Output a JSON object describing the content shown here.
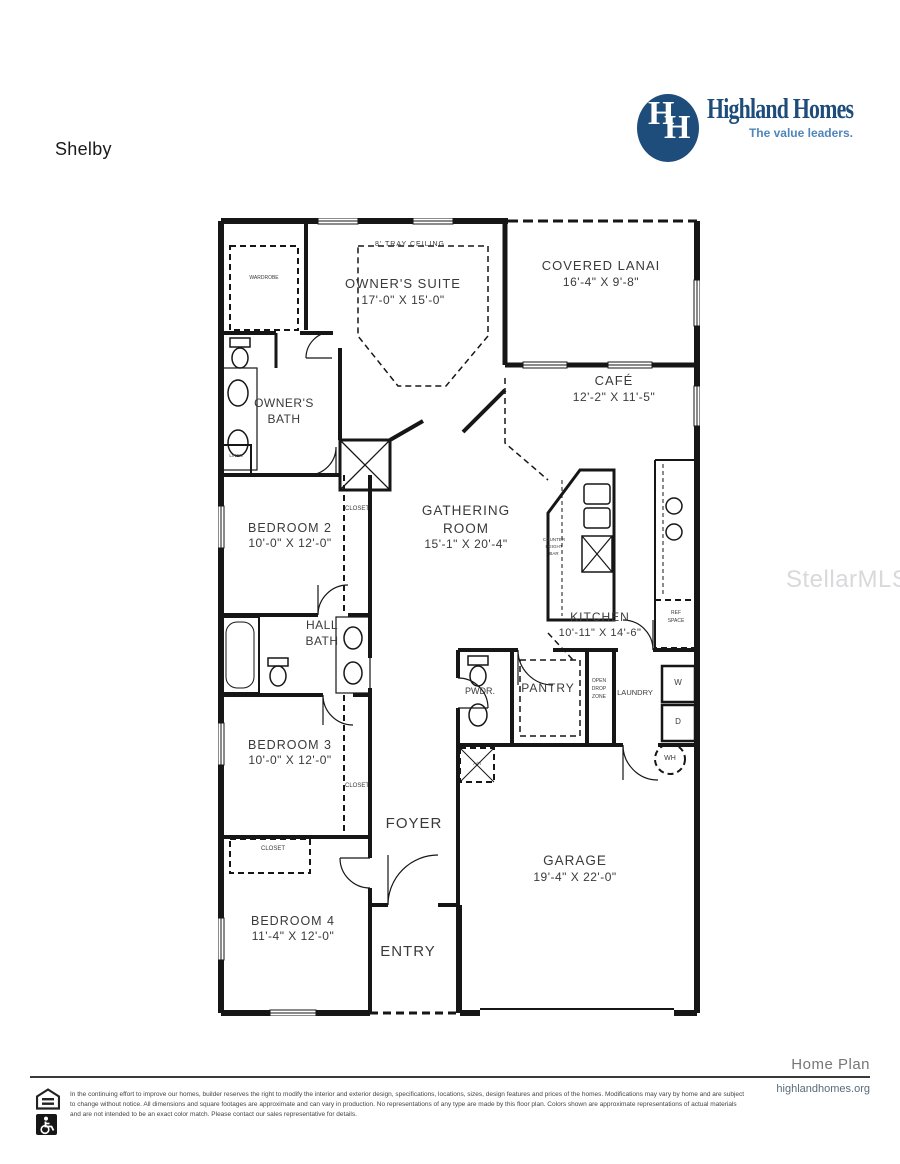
{
  "page": {
    "title": "Shelby",
    "watermark": "StellarMLS"
  },
  "logo": {
    "monogram_left": "H",
    "monogram_right": "H",
    "name": "Highland Homes",
    "tagline": "The value leaders.",
    "navy": "#1e4d7b",
    "light_blue": "#4f86ba"
  },
  "rooms": {
    "tray_ceiling": {
      "note": "8' TRAY CEILING"
    },
    "owners_suite": {
      "name": "OWNER'S SUITE",
      "dims": "17'-0\" X 15'-0\""
    },
    "covered_lanai": {
      "name": "COVERED LANAI",
      "dims": "16'-4\" X 9'-8\""
    },
    "cafe": {
      "name": "CAFÉ",
      "dims": "12'-2\" X 11'-5\""
    },
    "wardrobe": {
      "name": "WARDROBE"
    },
    "owners_bath": {
      "name": "OWNER'S BATH"
    },
    "linen": {
      "name": "LINEN"
    },
    "bedroom2": {
      "name": "BEDROOM 2",
      "dims": "10'-0\" X 12'-0\""
    },
    "closet2": {
      "name": "CLOSET"
    },
    "gathering_room": {
      "name": "GATHERING ROOM",
      "dims": "15'-1\" X 20'-4\""
    },
    "counter_bar": {
      "line1": "COUNTER",
      "line2": "HEIGHT",
      "line3": "BAR"
    },
    "kitchen": {
      "name": "KITCHEN",
      "dims": "10'-11\" X 14'-6\""
    },
    "ref_space": {
      "line1": "REF",
      "line2": "SPACE"
    },
    "hall_bath": {
      "line1": "HALL",
      "line2": "BATH"
    },
    "powder": {
      "name": "PWDR."
    },
    "pantry": {
      "name": "PANTRY"
    },
    "drop_zone": {
      "line1": "OPEN",
      "line2": "DROP",
      "line3": "ZONE"
    },
    "laundry": {
      "name": "LAUNDRY",
      "washer": "W",
      "dryer": "D"
    },
    "water_heater": {
      "name": "WH"
    },
    "air_handler": {
      "name": "A/H"
    },
    "bedroom3": {
      "name": "BEDROOM 3",
      "dims": "10'-0\" X 12'-0\""
    },
    "closet3": {
      "name": "CLOSET"
    },
    "foyer": {
      "name": "FOYER"
    },
    "closet4": {
      "name": "CLOSET"
    },
    "bedroom4": {
      "name": "BEDROOM 4",
      "dims": "11'-4\" X 12'-0\""
    },
    "entry": {
      "name": "ENTRY"
    },
    "garage": {
      "name": "GARAGE",
      "dims": "19'-4\" X 22'-0\""
    }
  },
  "footer": {
    "plan_label": "Home Plan",
    "website": "highlandhomes.org",
    "disclaimer": "In the continuing effort to improve our homes, builder reserves the right to modify the interior and exterior design, specifications, locations, sizes, design features and prices of the homes. Modifications may vary by home and are subject to change without notice. All dimensions and square footages are approximate and can vary in production. No representations of any type are made by this floor plan. Colors shown are approximate representations of actual materials and are not intended to be an exact color match. Please contact our sales representative for details.",
    "icons": {
      "left": "equal-housing-icon",
      "right": "accessibility-icon"
    }
  }
}
